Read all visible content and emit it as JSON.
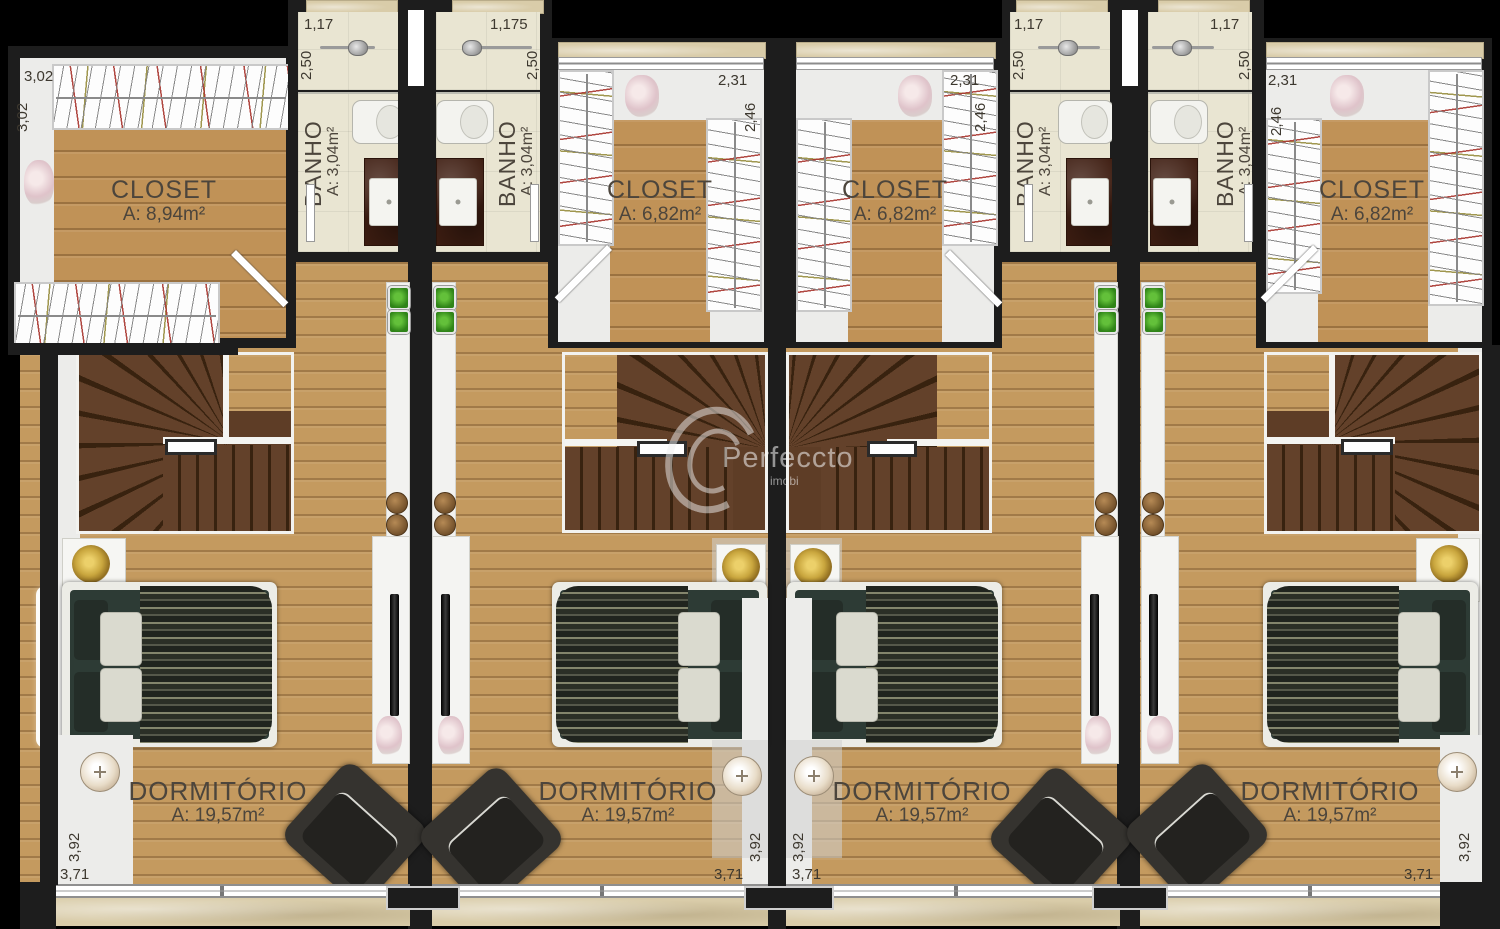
{
  "watermark": {
    "brand": "Perfeccto",
    "sub": "imobi"
  },
  "colors": {
    "wood": "#c49a5f",
    "wall": "#1d1d1d",
    "bath_floor": "#e9e5d2",
    "stair": "#5e3d26",
    "gold": "#c9a63e"
  },
  "units": [
    {
      "closet": {
        "label": "CLOSET",
        "area": "A: 8,94m²",
        "dim_a": "3,02",
        "dim_b": "3,02"
      },
      "banho": {
        "label": "BANHO",
        "area": "A: 3,04m²",
        "dim_a": "1,17",
        "dim_b": "2,50"
      },
      "dorm": {
        "label": "DORMITÓRIO",
        "area": "A: 19,57m²",
        "dim_a": "3,92",
        "dim_b": "3,71"
      }
    },
    {
      "closet": {
        "label": "CLOSET",
        "area": "A: 6,82m²",
        "dim_a": "2,31",
        "dim_b": "2,46"
      },
      "banho": {
        "label": "BANHO",
        "area": "A: 3,04m²",
        "dim_a": "1,175",
        "dim_b": "2,50"
      },
      "dorm": {
        "label": "DORMITÓRIO",
        "area": "A: 19,57m²",
        "dim_a": "3,92",
        "dim_b": "3,71"
      }
    },
    {
      "closet": {
        "label": "CLOSET",
        "area": "A: 6,82m²",
        "dim_a": "2,31",
        "dim_b": "2,46"
      },
      "banho": {
        "label": "BANHO",
        "area": "A: 3,04m²",
        "dim_a": "1,17",
        "dim_b": "2,50"
      },
      "dorm": {
        "label": "DORMITÓRIO",
        "area": "A: 19,57m²",
        "dim_a": "3,92",
        "dim_b": "3,71"
      }
    },
    {
      "closet": {
        "label": "CLOSET",
        "area": "A: 6,82m²",
        "dim_a": "2,31",
        "dim_b": "2,46"
      },
      "banho": {
        "label": "BANHO",
        "area": "A: 3,04m²",
        "dim_a": "1,17",
        "dim_b": "2,50"
      },
      "dorm": {
        "label": "DORMITÓRIO",
        "area": "A: 19,57m²",
        "dim_a": "3,92",
        "dim_b": "3,71"
      }
    }
  ]
}
